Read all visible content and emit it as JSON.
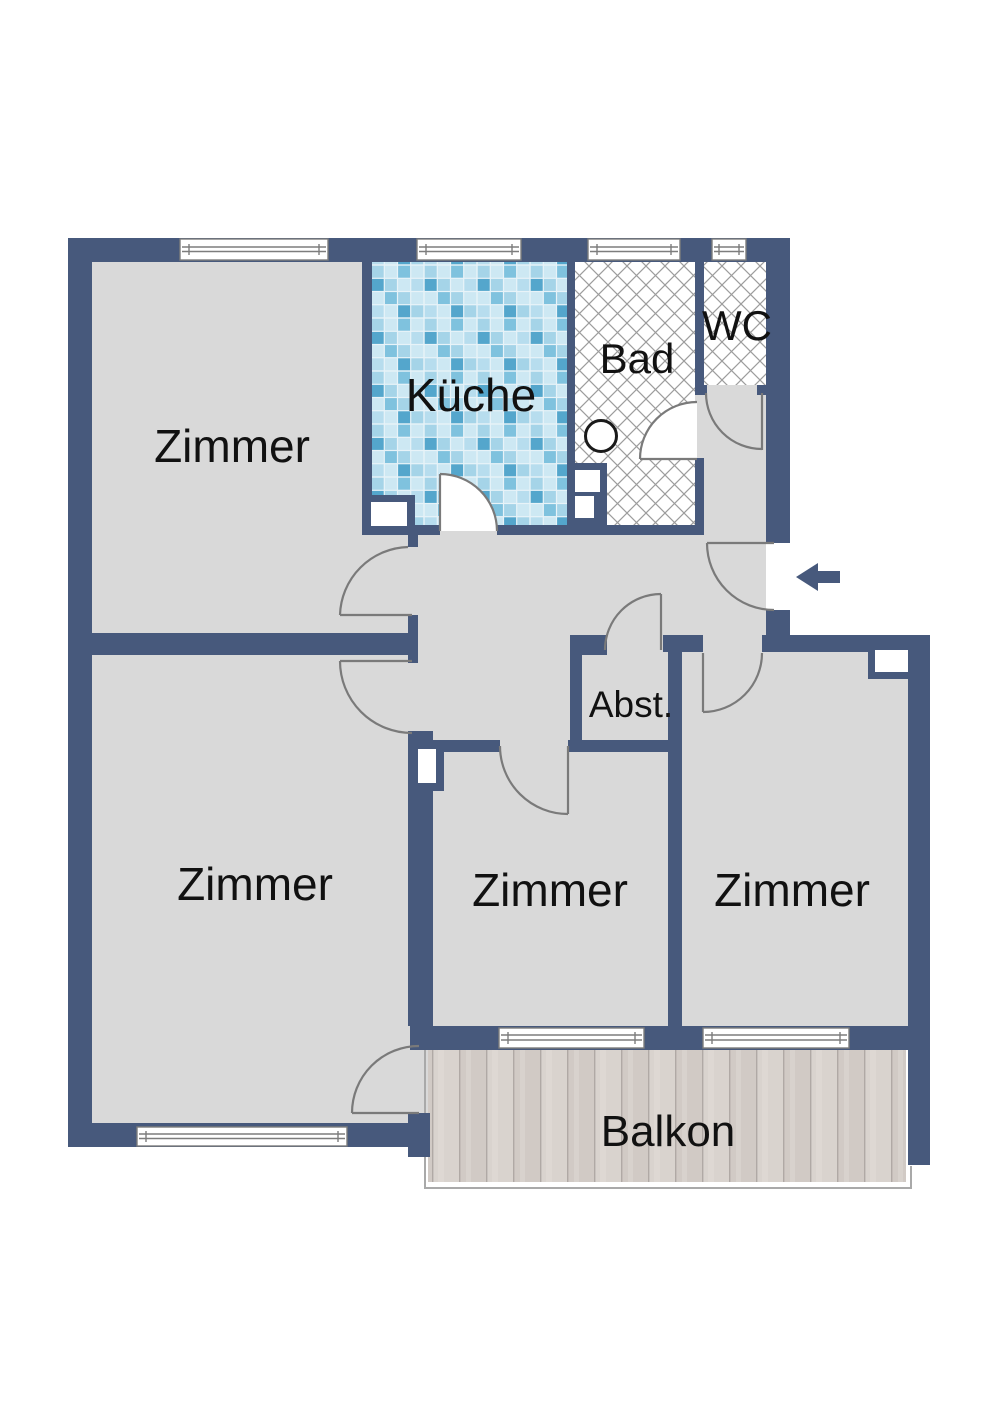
{
  "plan": {
    "rooms": {
      "zimmer_top_left": {
        "label": "Zimmer"
      },
      "kueche": {
        "label": "Küche"
      },
      "bad": {
        "label": "Bad"
      },
      "wc": {
        "label": "WC"
      },
      "abstellraum": {
        "label": "Abst."
      },
      "zimmer_bottom_left": {
        "label": "Zimmer"
      },
      "zimmer_middle": {
        "label": "Zimmer"
      },
      "zimmer_right": {
        "label": "Zimmer"
      },
      "balkon": {
        "label": "Balkon"
      }
    },
    "colors": {
      "wall": "#47597c",
      "floor": "#d9d9d9",
      "door_arc": "#7a7a7a",
      "hatch_line": "#9c9c9c",
      "tile_base": "#a5d4e8",
      "wood": "#d7d1cc",
      "window_frame": "#7d7d7d",
      "label": "#111111"
    },
    "icons": {
      "entrance_arrow": "arrow-left"
    }
  }
}
